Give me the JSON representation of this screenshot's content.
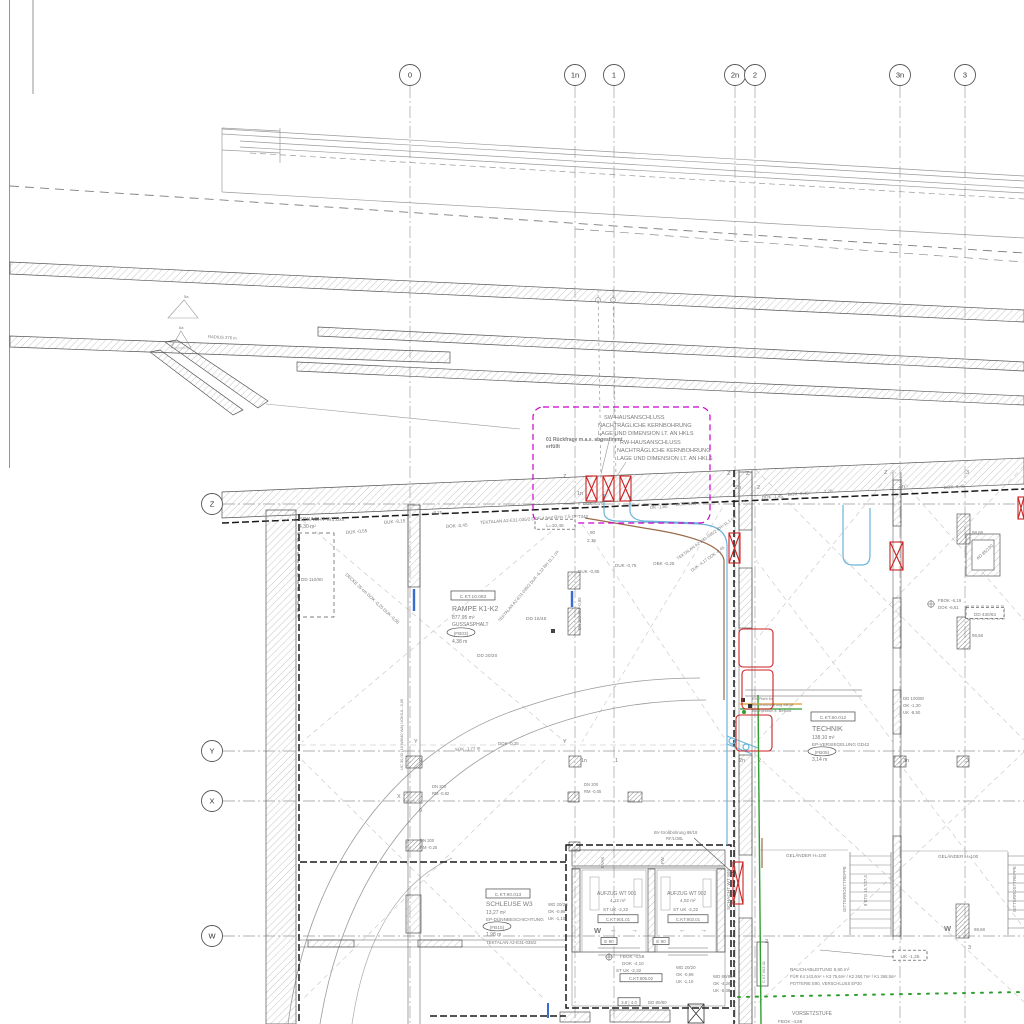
{
  "colors": {
    "magenta": "#cc00cc",
    "red": "#cc2222",
    "cyan": "#6ab4d8",
    "brown": "#9a6a4a",
    "green": "#2e9e2e",
    "orange": "#e09a28",
    "line": "#6f6f6f",
    "text": "#7a7a7a"
  },
  "grid": {
    "bubble_row_y": 75,
    "bubble_col_x": 212,
    "columns": [
      {
        "label": "0",
        "x": 410
      },
      {
        "label": "1n",
        "x": 575
      },
      {
        "label": "1",
        "x": 614
      },
      {
        "label": "2n",
        "x": 735
      },
      {
        "label": "2",
        "x": 755
      },
      {
        "label": "3n",
        "x": 900
      },
      {
        "label": "3",
        "x": 965
      }
    ],
    "rows": [
      {
        "label": "Z",
        "y": 504
      },
      {
        "label": "Y",
        "y": 751
      },
      {
        "label": "X",
        "y": 801
      },
      {
        "label": "W",
        "y": 936
      }
    ]
  },
  "texts": [
    {
      "t": "SW-HAUSANSCHLUSS",
      "x": 604,
      "y": 419,
      "s": 5.6
    },
    {
      "t": "NACHTRÄGLICHE KERNBOHRUNG",
      "x": 598,
      "y": 427,
      "s": 5.6
    },
    {
      "t": "LAGE UND DIMENSION LT. AN HKLS",
      "x": 598,
      "y": 435,
      "s": 5.6
    },
    {
      "t": "RW-HAUSANSCHLUSS",
      "x": 620,
      "y": 444,
      "s": 5.6
    },
    {
      "t": "NACHTRÄGLICHE KERNBOHRUNG",
      "x": 617,
      "y": 452,
      "s": 5.6
    },
    {
      "t": "LAGE UND DIMENSION LT. AN HKLS",
      "x": 617,
      "y": 460,
      "s": 5.6
    },
    {
      "t": "01 Rückfrage m.a.s. abgestimmt",
      "x": 546,
      "y": 441,
      "s": 5,
      "c": "#cc00cc",
      "w": "bold",
      "n": "revision-note"
    },
    {
      "t": "erfüllt",
      "x": 546,
      "y": 448,
      "s": 5,
      "c": "#cc00cc",
      "w": "bold"
    },
    {
      "t": "SCHACHT W1.8xx",
      "x": 299,
      "y": 521,
      "s": 5.4,
      "c": "#555",
      "n": "room-label-schacht-w18"
    },
    {
      "t": "4,30 m²",
      "x": 299,
      "y": 528,
      "s": 5
    },
    {
      "t": "DD 110/80",
      "x": 301,
      "y": 581,
      "s": 4.6
    },
    {
      "t": "DUK -0,55",
      "x": 346,
      "y": 534,
      "s": 4.6,
      "r": -5
    },
    {
      "t": "DUK -8,15",
      "x": 384,
      "y": 524,
      "s": 4.6,
      "r": -5
    },
    {
      "t": "DECKE 35 cm  DOK -0,25  DUK -0,55",
      "x": 345,
      "y": 575,
      "s": 4.4,
      "r": 43
    },
    {
      "t": "-8,25",
      "x": 432,
      "y": 514,
      "s": 4.4
    },
    {
      "t": "DOK -0,45",
      "x": 446,
      "y": 528,
      "s": 4.6,
      "r": -4
    },
    {
      "t": "TEKTALAN A2-E31-035/2  DOF 4,5m²  RH= 7,5 cm",
      "x": 480,
      "y": 524,
      "s": 4.4,
      "r": -4
    },
    {
      "t": "DUK -0,75",
      "x": 583,
      "y": 505,
      "s": 4.4
    },
    {
      "t": "T340",
      "x": 578,
      "y": 518,
      "s": 4.4
    },
    {
      "t": "90",
      "x": 590,
      "y": 534,
      "s": 4.6
    },
    {
      "t": "2,15",
      "x": 587,
      "y": 542,
      "s": 4.6
    },
    {
      "t": "L=10,45",
      "x": 555,
      "y": 527,
      "s": 4.8,
      "a": "middle",
      "box": {
        "type": "dash",
        "w": 40,
        "h": 10
      }
    },
    {
      "t": "OK -1,80",
      "x": 650,
      "y": 509,
      "s": 4.4,
      "r": -4
    },
    {
      "t": "DOK -1,45",
      "x": 676,
      "y": 506,
      "s": 4.4,
      "r": -4
    },
    {
      "t": "DOK -1,45",
      "x": 762,
      "y": 499,
      "s": 4.4,
      "r": -4
    },
    {
      "t": "DOK -0,45",
      "x": 788,
      "y": 496,
      "s": 4.4,
      "r": -4
    },
    {
      "t": "1,20",
      "x": 824,
      "y": 493,
      "s": 4.4,
      "r": -4
    },
    {
      "t": "DUK -0,85",
      "x": 578,
      "y": 573,
      "s": 4.6
    },
    {
      "t": "DUK -0,75",
      "x": 615,
      "y": 567,
      "s": 4.6
    },
    {
      "t": "OBK -0,25",
      "x": 653,
      "y": 565,
      "s": 4.6
    },
    {
      "t": "TEKTALAN A2-E31-035/2  RH=11,1 cm",
      "x": 678,
      "y": 560,
      "s": 4.2,
      "r": -36
    },
    {
      "t": "DUK -4,17   DOK -0,45",
      "x": 692,
      "y": 572,
      "s": 4.2,
      "r": -36
    },
    {
      "t": "C.KT.10.083",
      "x": 473,
      "y": 598,
      "s": 4.8,
      "c": "#333",
      "a": "middle",
      "box": {
        "type": "rect",
        "w": 44,
        "h": 9
      },
      "n": "room-code-rampe"
    },
    {
      "t": "RAMPE K1-K2",
      "x": 452,
      "y": 611,
      "s": 7,
      "c": "#333",
      "n": "room-label-rampe"
    },
    {
      "t": "877,95 m²",
      "x": 452,
      "y": 619,
      "s": 5
    },
    {
      "t": "GUSSASPHALT",
      "x": 452,
      "y": 626,
      "s": 5
    },
    {
      "t": "(FB03)",
      "x": 461,
      "y": 635,
      "s": 4.8,
      "a": "middle",
      "box": {
        "type": "oval",
        "w": 28,
        "h": 9
      }
    },
    {
      "t": "4,38 m",
      "x": 452,
      "y": 643,
      "s": 5
    },
    {
      "t": "DD 15/45",
      "x": 526,
      "y": 620,
      "s": 4.8
    },
    {
      "t": "DD 20/20",
      "x": 477,
      "y": 657,
      "s": 4.8
    },
    {
      "t": "TEKTALAN A2-E31-035/2  DUK -6,12  RH 11,1 cm",
      "x": 500,
      "y": 622,
      "s": 4.2,
      "r": -50
    },
    {
      "t": "C.KT.80.012",
      "x": 833,
      "y": 719,
      "s": 4.8,
      "c": "#333",
      "a": "middle",
      "box": {
        "type": "rect",
        "w": 44,
        "h": 9
      },
      "n": "room-code-technik"
    },
    {
      "t": "TECHNIK",
      "x": 812,
      "y": 731,
      "s": 7,
      "c": "#333",
      "n": "room-label-technik"
    },
    {
      "t": "138,10 m²",
      "x": 812,
      "y": 739,
      "s": 5
    },
    {
      "t": "EP-VERSIEGELUNG GD42",
      "x": 812,
      "y": 746,
      "s": 4.6
    },
    {
      "t": "(FB05)",
      "x": 822,
      "y": 754,
      "s": 4.8,
      "a": "middle",
      "box": {
        "type": "oval",
        "w": 28,
        "h": 9
      }
    },
    {
      "t": "3,14 m",
      "x": 812,
      "y": 761,
      "s": 5
    },
    {
      "t": "DD 100/80",
      "x": 903,
      "y": 700,
      "s": 4.4
    },
    {
      "t": "OK -1,30",
      "x": 903,
      "y": 707,
      "s": 4.4
    },
    {
      "t": "UK -8,50",
      "x": 903,
      "y": 714,
      "s": 4.4
    },
    {
      "t": "C.KT.90.013",
      "x": 508,
      "y": 896,
      "s": 4.8,
      "c": "#333",
      "a": "middle",
      "box": {
        "type": "rect",
        "w": 44,
        "h": 9
      },
      "n": "room-code-schleuse"
    },
    {
      "t": "SCHLEUSE W3",
      "x": 486,
      "y": 906,
      "s": 6.5,
      "c": "#333",
      "n": "room-label-schleuse"
    },
    {
      "t": "13,27 m²",
      "x": 486,
      "y": 914,
      "s": 5
    },
    {
      "t": "EP-DÜNNBESCHICHTUNG",
      "x": 486,
      "y": 921,
      "s": 4.6
    },
    {
      "t": "(FB15)",
      "x": 497,
      "y": 929,
      "s": 4.8,
      "a": "middle",
      "box": {
        "type": "oval",
        "w": 28,
        "h": 9
      }
    },
    {
      "t": "1,98 m",
      "x": 486,
      "y": 936,
      "s": 5
    },
    {
      "t": "TEKTALAN A2-E31-035/2",
      "x": 486,
      "y": 944,
      "s": 4.4
    },
    {
      "t": "WD 20/28",
      "x": 548,
      "y": 906,
      "s": 4.4
    },
    {
      "t": "OK -0,98",
      "x": 548,
      "y": 913,
      "s": 4.4
    },
    {
      "t": "UK -1,10",
      "x": 548,
      "y": 920,
      "s": 4.4
    },
    {
      "t": "AUFZUG WT 901",
      "x": 597,
      "y": 895,
      "s": 5,
      "c": "#444",
      "n": "room-label-aufzug-901"
    },
    {
      "t": "4,12 m²",
      "x": 610,
      "y": 902,
      "s": 4.6
    },
    {
      "t": "ST UK -2,22",
      "x": 603,
      "y": 911,
      "s": 4.6
    },
    {
      "t": "C.KT.901.01",
      "x": 618,
      "y": 921,
      "s": 4.4,
      "c": "#333",
      "a": "middle",
      "box": {
        "type": "rect",
        "w": 40,
        "h": 8
      }
    },
    {
      "t": "AUFZUG WT 902",
      "x": 667,
      "y": 895,
      "s": 5,
      "c": "#444",
      "n": "room-label-aufzug-902"
    },
    {
      "t": "4,02 m²",
      "x": 680,
      "y": 902,
      "s": 4.6
    },
    {
      "t": "ST UK -2,22",
      "x": 673,
      "y": 911,
      "s": 4.6
    },
    {
      "t": "C.KT.902.01",
      "x": 688,
      "y": 921,
      "s": 4.4,
      "c": "#333",
      "a": "middle",
      "box": {
        "type": "rect",
        "w": 40,
        "h": 8
      }
    },
    {
      "t": "EVAK",
      "x": 604,
      "y": 868,
      "s": 4.4,
      "r": -90
    },
    {
      "t": "FW",
      "x": 664,
      "y": 864,
      "s": 4.4,
      "r": -90
    },
    {
      "t": "SCHACHT WT 905",
      "x": 730,
      "y": 910,
      "s": 4.8,
      "r": -90,
      "n": "room-label-schacht-905"
    },
    {
      "t": "E 90",
      "x": 609,
      "y": 943,
      "s": 4.6,
      "c": "#333",
      "a": "middle",
      "box": {
        "type": "rect",
        "w": 16,
        "h": 7
      }
    },
    {
      "t": "E 90",
      "x": 661,
      "y": 943,
      "s": 4.6,
      "c": "#333",
      "a": "middle",
      "box": {
        "type": "rect",
        "w": 16,
        "h": 7
      }
    },
    {
      "t": "FBOK -4,58",
      "x": 620,
      "y": 958,
      "s": 4.6
    },
    {
      "t": "DOK -4,10",
      "x": 622,
      "y": 965,
      "s": 4.6
    },
    {
      "t": "ST UK -2,32",
      "x": 616,
      "y": 972,
      "s": 4.6
    },
    {
      "t": "C.KT.905.02",
      "x": 641,
      "y": 980,
      "s": 4.4,
      "c": "#333",
      "a": "middle",
      "box": {
        "type": "rect",
        "w": 42,
        "h": 8
      }
    },
    {
      "t": "WD 20/20",
      "x": 676,
      "y": 969,
      "s": 4.4
    },
    {
      "t": "OK -0,98",
      "x": 676,
      "y": 976,
      "s": 4.4
    },
    {
      "t": "UK -1,10",
      "x": 676,
      "y": 983,
      "s": 4.4
    },
    {
      "t": "WD 80/80",
      "x": 713,
      "y": 978,
      "s": 4.4
    },
    {
      "t": "OK -4,26",
      "x": 713,
      "y": 985,
      "s": 4.4
    },
    {
      "t": "UK -5,38",
      "x": 713,
      "y": 992,
      "s": 4.4
    },
    {
      "t": "DD 80/80",
      "x": 648,
      "y": 1004,
      "s": 4.4
    },
    {
      "t": "3,8 | 4,0",
      "x": 629,
      "y": 1004,
      "s": 4.4,
      "c": "#333",
      "a": "middle",
      "box": {
        "type": "rect",
        "w": 22,
        "h": 8
      }
    },
    {
      "t": "GELÄNDER H=100",
      "x": 786,
      "y": 857,
      "s": 4.6
    },
    {
      "t": "GELÄNDER H=100",
      "x": 938,
      "y": 858,
      "s": 4.6
    },
    {
      "t": "GITTERROSTTREPPE",
      "x": 846,
      "y": 912,
      "s": 4.4,
      "r": -90
    },
    {
      "t": "9 STG 16,7/27,3",
      "x": 867,
      "y": 906,
      "s": 4.2,
      "r": -90
    },
    {
      "t": "GITTERROSTTREPPE",
      "x": 1016,
      "y": 912,
      "s": 4.4,
      "r": -90
    },
    {
      "t": "UK -1,25",
      "x": 910,
      "y": 958,
      "s": 4.8,
      "a": "middle",
      "box": {
        "type": "dash",
        "w": 34,
        "h": 10
      }
    },
    {
      "t": "RAUCHABLEITUNG 8,60 m²",
      "x": 790,
      "y": 971,
      "s": 4.6
    },
    {
      "t": "FÜR K4 143,6m² + K3 75,6m² / K2 260,7m² / K1 368,5m²",
      "x": 790,
      "y": 978,
      "s": 4.2
    },
    {
      "t": "POTTERIE E90, VERSCHLUSS EP30",
      "x": 790,
      "y": 985,
      "s": 4.2
    },
    {
      "t": "VORSETZSTUFE",
      "x": 792,
      "y": 1015,
      "s": 5
    },
    {
      "t": "FBOK -4,68",
      "x": 778,
      "y": 1023,
      "s": 4.6
    },
    {
      "t": "98,68",
      "x": 972,
      "y": 534,
      "s": 4.4
    },
    {
      "t": "98,68",
      "x": 972,
      "y": 637,
      "s": 4.4
    },
    {
      "t": "98,68",
      "x": 974,
      "y": 931,
      "s": 4.4
    },
    {
      "t": "AD 85/130",
      "x": 978,
      "y": 560,
      "s": 4.4,
      "r": -42
    },
    {
      "t": "DD 430/63",
      "x": 985,
      "y": 616,
      "s": 4.6,
      "a": "middle",
      "box": {
        "type": "dash",
        "w": 38,
        "h": 11
      }
    },
    {
      "t": "FBOK -6,19",
      "x": 938,
      "y": 602,
      "s": 4.4
    },
    {
      "t": "DOK -6,61",
      "x": 938,
      "y": 609,
      "s": 4.4
    },
    {
      "t": "DOK -0,45",
      "x": 944,
      "y": 489,
      "s": 4.4,
      "r": -4
    },
    {
      "t": "BV-Großbohrung 88/18",
      "x": 654,
      "y": 834,
      "s": 4.2
    },
    {
      "t": "RF/LOBL",
      "x": 666,
      "y": 840,
      "s": 4.2
    },
    {
      "t": "BV-Pfahl Nr.",
      "x": 752,
      "y": 700,
      "s": 4
    },
    {
      "t": "BV-Großbohrung 88/18",
      "x": 752,
      "y": 706,
      "s": 4
    },
    {
      "t": "BV-Injektion lt. Befund",
      "x": 752,
      "y": 712,
      "s": 4
    },
    {
      "t": "DN 200",
      "x": 584,
      "y": 786,
      "s": 4.2
    },
    {
      "t": "RM -0,05",
      "x": 584,
      "y": 793,
      "s": 4.2
    },
    {
      "t": "DN 200",
      "x": 432,
      "y": 788,
      "s": 4.2
    },
    {
      "t": "RM -0,82",
      "x": 432,
      "y": 795,
      "s": 4.2
    },
    {
      "t": "DN 200",
      "x": 420,
      "y": 842,
      "s": 4.2
    },
    {
      "t": "RM -0,25",
      "x": 420,
      "y": 849,
      "s": 4.2
    },
    {
      "t": "DOK -0,25",
      "x": 498,
      "y": 745,
      "s": 4.4
    },
    {
      "t": "SOK -1,77 m",
      "x": 455,
      "y": 751,
      "s": 4.4,
      "r": -3
    },
    {
      "t": "UC 30,00 (16 W8/40 WA)  UOK/UL -3,05",
      "x": 403,
      "y": 770,
      "s": 4,
      "r": -90
    },
    {
      "t": "DN 200 RM -0,85",
      "x": 581,
      "y": 630,
      "s": 4.2,
      "r": -90
    },
    {
      "t": "RADIUS 276 m",
      "x": 208,
      "y": 338,
      "s": 4.2,
      "r": 3
    },
    {
      "t": "5a",
      "x": 184,
      "y": 298,
      "s": 4
    },
    {
      "t": "6a",
      "x": 179,
      "y": 329,
      "s": 4
    },
    {
      "t": "Z",
      "x": 563,
      "y": 478,
      "s": 5.5,
      "c": "#333"
    },
    {
      "t": "1n",
      "x": 577,
      "y": 495,
      "s": 5.5,
      "c": "#333"
    },
    {
      "t": "Z",
      "x": 727,
      "y": 475,
      "s": 5.5,
      "c": "#333"
    },
    {
      "t": "Z",
      "x": 746,
      "y": 475,
      "s": 5.5,
      "c": "#333"
    },
    {
      "t": "2n",
      "x": 735,
      "y": 489,
      "s": 5.5,
      "c": "#333"
    },
    {
      "t": "2",
      "x": 757,
      "y": 489,
      "s": 5.5,
      "c": "#333"
    },
    {
      "t": "Z",
      "x": 884,
      "y": 474,
      "s": 5.5,
      "c": "#333"
    },
    {
      "t": "3n",
      "x": 899,
      "y": 488,
      "s": 5.5,
      "c": "#333"
    },
    {
      "t": "3",
      "x": 966,
      "y": 474,
      "s": 5.5,
      "c": "#333"
    },
    {
      "t": "Y",
      "x": 414,
      "y": 743,
      "s": 5.5,
      "c": "#333"
    },
    {
      "t": "Y",
      "x": 563,
      "y": 743,
      "s": 5.5,
      "c": "#333"
    },
    {
      "t": "0",
      "x": 419,
      "y": 762,
      "s": 5.5,
      "c": "#333"
    },
    {
      "t": "1n",
      "x": 581,
      "y": 762,
      "s": 5.5,
      "c": "#333"
    },
    {
      "t": "1",
      "x": 615,
      "y": 762,
      "s": 5.5,
      "c": "#333"
    },
    {
      "t": "2n",
      "x": 739,
      "y": 762,
      "s": 5.5,
      "c": "#333"
    },
    {
      "t": "2",
      "x": 758,
      "y": 762,
      "s": 5.5,
      "c": "#333"
    },
    {
      "t": "3n",
      "x": 903,
      "y": 762,
      "s": 5.5,
      "c": "#333"
    },
    {
      "t": "3",
      "x": 966,
      "y": 762,
      "s": 5.5,
      "c": "#333"
    },
    {
      "t": "X",
      "x": 397,
      "y": 798,
      "s": 5.5,
      "c": "#333"
    },
    {
      "t": "0",
      "x": 419,
      "y": 812,
      "s": 5.5,
      "c": "#333"
    },
    {
      "t": "W",
      "x": 594,
      "y": 933,
      "s": 7.5,
      "c": "#222",
      "w": "bold"
    },
    {
      "t": "2",
      "x": 765,
      "y": 943,
      "s": 5.5,
      "c": "#333"
    },
    {
      "t": "W",
      "x": 944,
      "y": 931,
      "s": 7.5,
      "c": "#222",
      "w": "bold"
    },
    {
      "t": "3",
      "x": 968,
      "y": 949,
      "s": 5.5,
      "c": "#333"
    },
    {
      "t": "C.KT.903.01",
      "x": 765,
      "y": 983,
      "s": 4,
      "r": -90,
      "c": "#333",
      "n": "room-code-903"
    },
    {
      "t": "←",
      "x": 610,
      "y": 932,
      "s": 7,
      "c": "#444"
    },
    {
      "t": "→",
      "x": 631,
      "y": 932,
      "s": 7,
      "c": "#444"
    },
    {
      "t": "←",
      "x": 679,
      "y": 932,
      "s": 7,
      "c": "#444"
    },
    {
      "t": "→",
      "x": 700,
      "y": 932,
      "s": 7,
      "c": "#444"
    }
  ]
}
